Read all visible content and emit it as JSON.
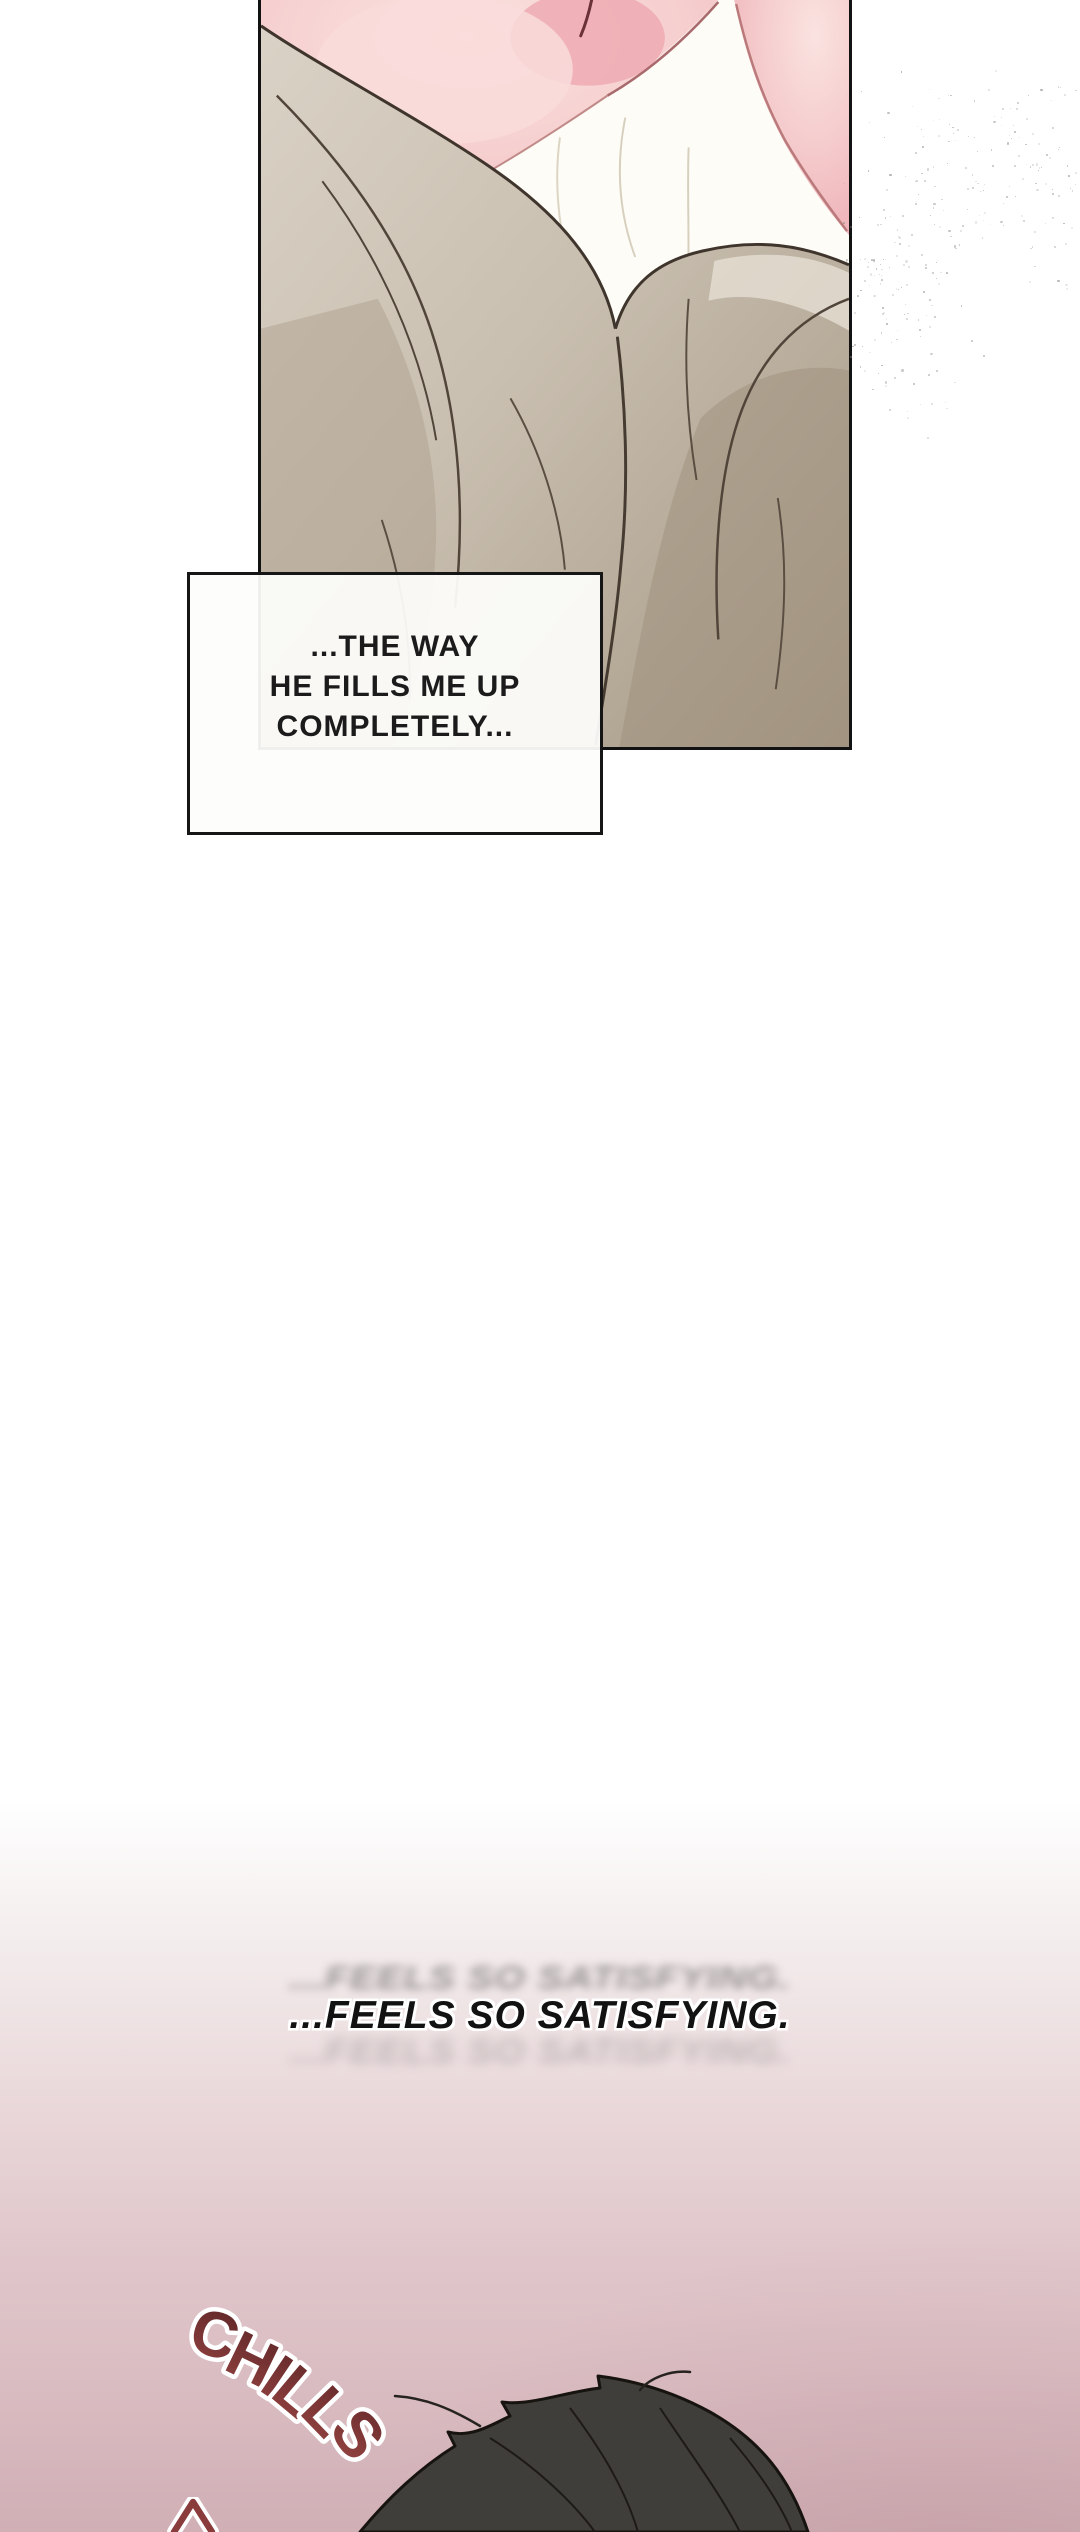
{
  "speech_box": {
    "lines": [
      "...THE WAY",
      "HE FILLS ME UP",
      "COMPLETELY..."
    ]
  },
  "narration": {
    "text": "...FEELS SO SATISFYING."
  },
  "sfx": {
    "chills": "CHILLS"
  },
  "colors": {
    "panel_border": "#121212",
    "skin_light": "#f8dcd9",
    "skin_deep": "#eba7ae",
    "sheet_white": "#fdfcf6",
    "fabric_light": "#d8d0c4",
    "fabric_mid": "#c6bbab",
    "fabric_shadow": "#a69985",
    "fold_line": "#463b2f",
    "dust_gray": "#85807a",
    "pink_gradient_bottom": "#d0afb5",
    "chills_dark": "#5c2426",
    "chills_light": "#9a4744",
    "hair_fill": "#403e3a",
    "hair_line": "#17140f"
  }
}
